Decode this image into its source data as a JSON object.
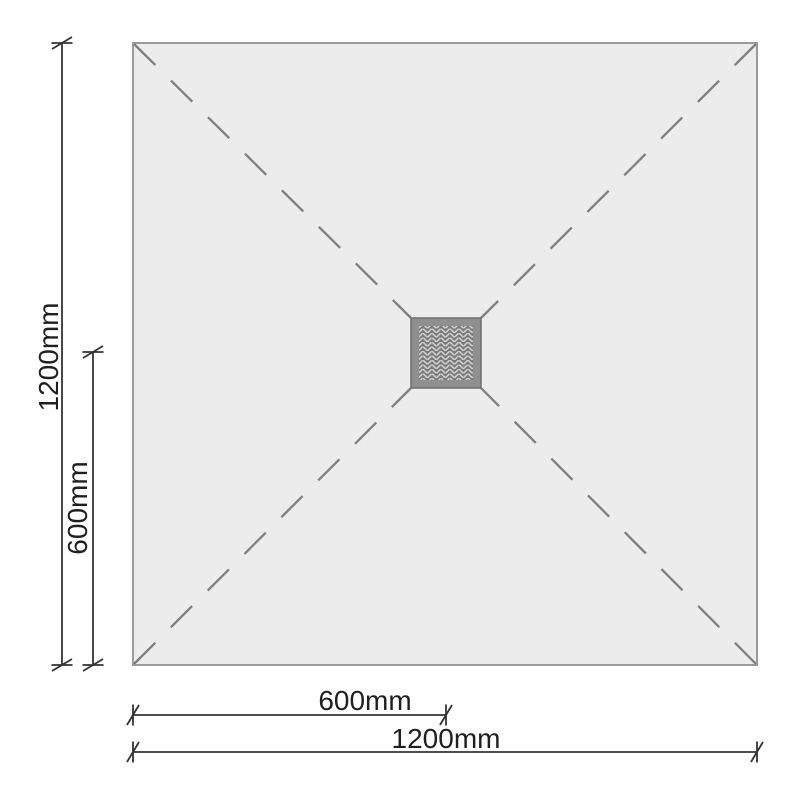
{
  "diagram": {
    "type": "shower-tray-plan",
    "labels": {
      "left_outer": "1200mm",
      "left_inner": "600mm",
      "bottom_inner": "600mm",
      "bottom_outer": "1200mm"
    },
    "colors": {
      "background": "#ffffff",
      "tray_fill": "#ececec",
      "tray_border": "#9b9b9b",
      "diagonal_dash": "#7f7f7f",
      "drain_frame": "#8f8f8f",
      "drain_frame_edge": "#6f6f6f",
      "drain_inner": "#7b7b7b",
      "drain_pattern": "#d2d2d2",
      "dimension_line": "#333333",
      "label_text": "#1f1f1f"
    }
  }
}
